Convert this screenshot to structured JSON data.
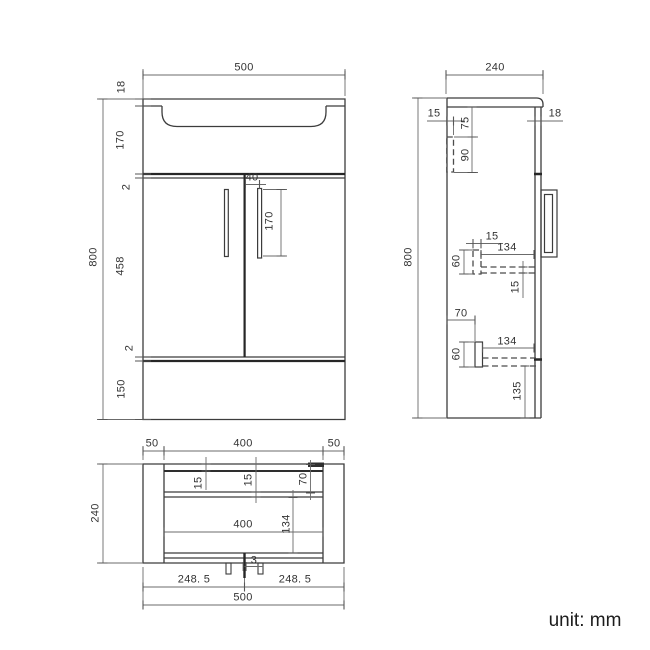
{
  "drawing": {
    "unit_note": "unit: mm",
    "front_view": {
      "overall_width": "500",
      "counter_thickness": "18",
      "basin_section_height": "170",
      "top_gap": "2",
      "door_height": "458",
      "bottom_gap": "2",
      "plinth_height": "150",
      "overall_height": "800",
      "handle_inset": "40",
      "handle_length": "170"
    },
    "side_view": {
      "overall_depth": "240",
      "back_rail_thickness": "15",
      "rail_top_offset": "75",
      "back_rail_height": "90",
      "door_thickness": "18",
      "overall_height": "800",
      "upper_batten_width": "15",
      "upper_batten_height": "60",
      "upper_shelf_depth": "134",
      "shelf_thickness": "15",
      "lower_batten_offset": "70",
      "lower_batten_height": "60",
      "lower_shelf_depth": "134",
      "bottom_clearance": "135"
    },
    "plan_view": {
      "left_overhang": "50",
      "body_width": "400",
      "right_overhang": "50",
      "overall_depth": "240",
      "back_panel_thickness": "15",
      "rail_thickness": "15",
      "corner_block_offset": "70",
      "inner_width": "400",
      "inner_depth": "134",
      "divider_gap": "3",
      "half_width_left": "248. 5",
      "half_width_right": "248. 5",
      "overall_width": "500"
    }
  }
}
